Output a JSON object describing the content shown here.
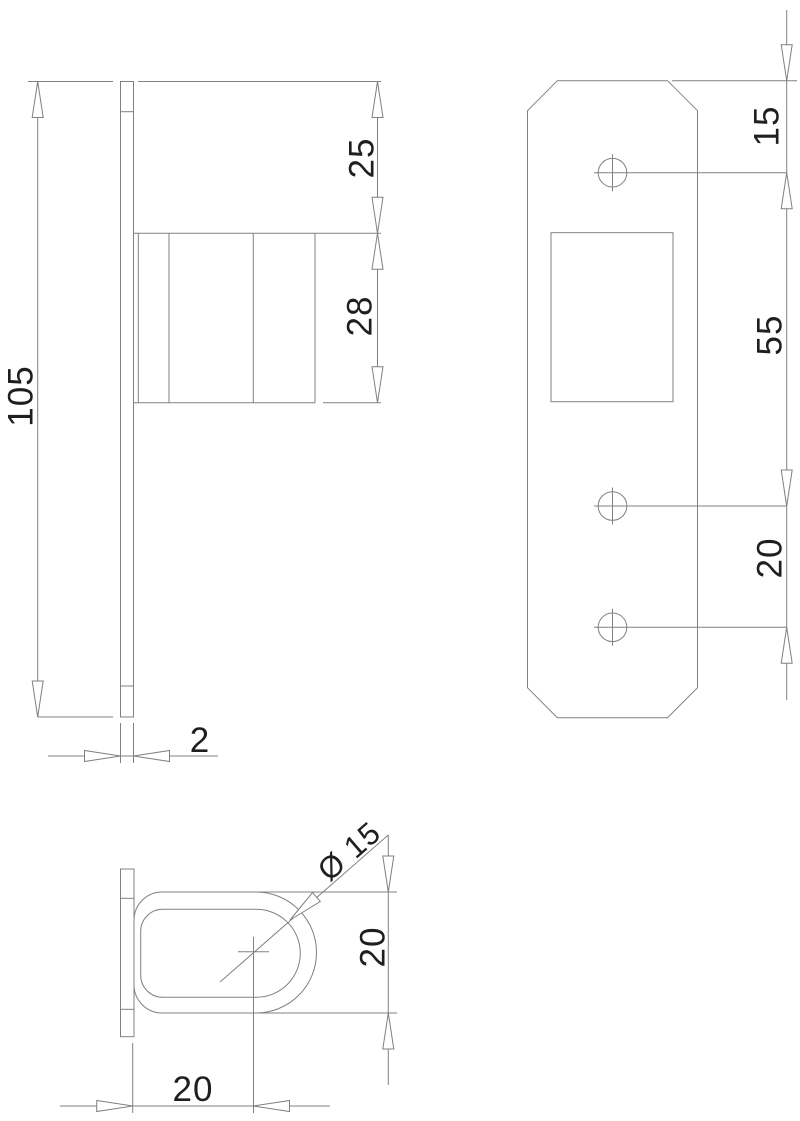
{
  "colors": {
    "line": "#808080",
    "text": "#1f1f1f",
    "background": "#ffffff"
  },
  "views": {
    "side": {
      "dims": {
        "height": "105",
        "top_offset": "25",
        "handle_width": "28",
        "plate_thickness": "2"
      }
    },
    "front": {
      "dims": {
        "hole_top_offset": "15",
        "hole_pitch_upper": "55",
        "hole_pitch_lower": "20"
      }
    },
    "top": {
      "dims": {
        "bore_diameter": "Ø 15",
        "tube_height": "20",
        "tube_center_offset": "20"
      }
    }
  }
}
